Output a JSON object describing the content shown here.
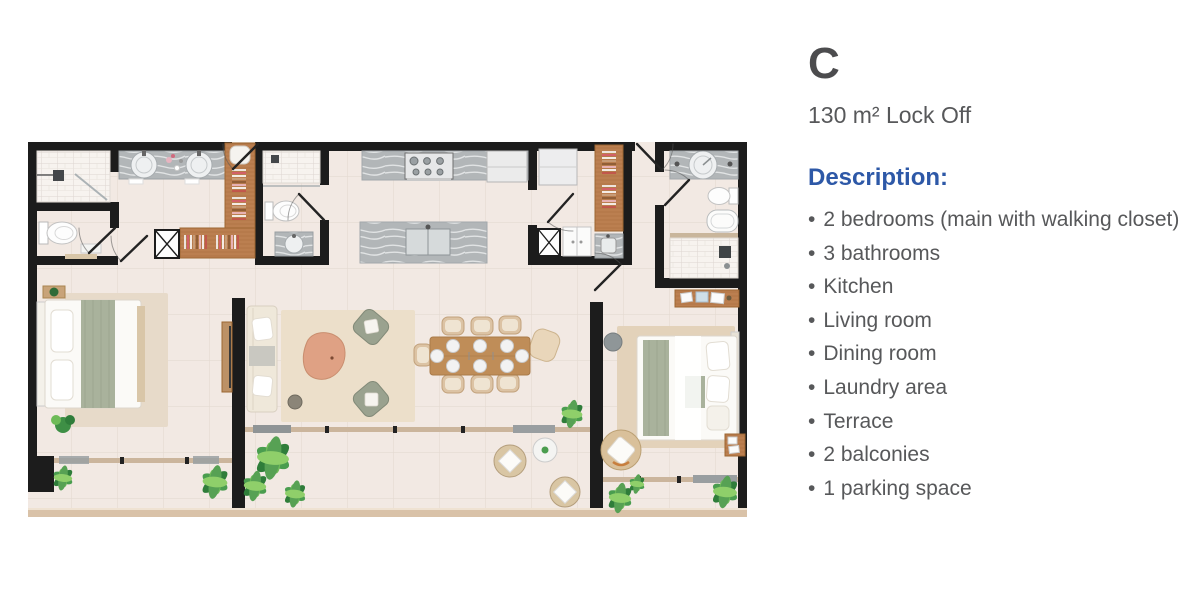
{
  "unit": {
    "title": "C",
    "area": "130 m² Lock Off"
  },
  "description": {
    "heading": "Description:",
    "items": [
      "2 bedrooms (main with walking closet)",
      "3 bathrooms",
      "Kitchen",
      "Living room",
      "Dining room",
      "Laundry area",
      "Terrace",
      "2 balconies",
      "1 parking space"
    ]
  },
  "colors": {
    "accent_blue": "#2d58a7",
    "text_gray": "#57585a",
    "wall_black": "#1c1c1c",
    "floor_beige": "#f2e9e3",
    "wood_brown": "#bb7f50"
  },
  "floor_plan": {
    "alt": "Top-view architectural floor plan of unit C"
  }
}
